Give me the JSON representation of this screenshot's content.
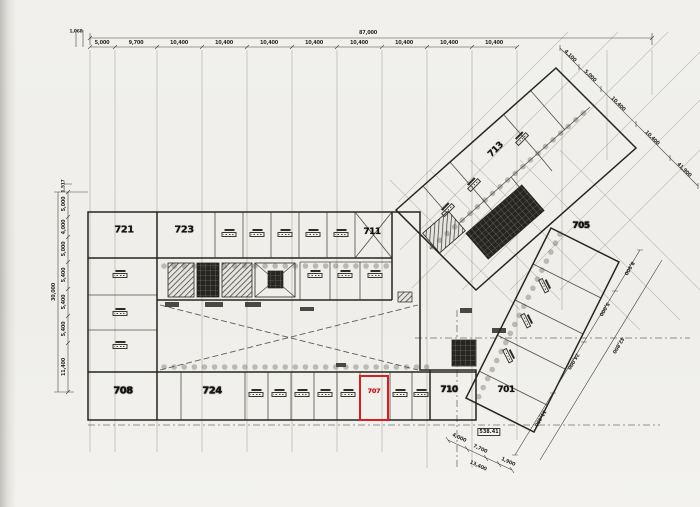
{
  "plan": {
    "type": "architectural floor plan (scanned blueprint)",
    "highlight_color": "#d81f1f"
  },
  "rooms": [
    {
      "label": "721"
    },
    {
      "label": "723"
    },
    {
      "label": "711"
    },
    {
      "label": "713"
    },
    {
      "label": "705"
    },
    {
      "label": "701"
    },
    {
      "label": "708"
    },
    {
      "label": "724"
    },
    {
      "label": "710"
    }
  ],
  "highlight": {
    "room": "707"
  },
  "dimensions": {
    "top": {
      "total": "87,000",
      "lead_in": "1,068",
      "segments": [
        "5,000",
        "9,700",
        "10,400",
        "10,400",
        "10,400",
        "10,400",
        "10,400",
        "10,400",
        "10,400",
        "10,400"
      ]
    },
    "left": {
      "total": "30,000",
      "lead_in": "1,517",
      "segments": [
        "5,000",
        "4,000",
        "5,000",
        "5,400",
        "5,400",
        "5,400",
        "11,400"
      ]
    },
    "upper_right": {
      "segments": [
        "4,100",
        "5,000",
        "10,400",
        "10,400",
        "41,900"
      ]
    },
    "lower_right": {
      "segments": [
        "8,900",
        "5,000",
        "24,000",
        "11,400",
        "42,800"
      ]
    },
    "bottom": {
      "segments": [
        "4,000",
        "7,700",
        "13,400",
        "1,900"
      ],
      "area_note": "538.41"
    }
  }
}
